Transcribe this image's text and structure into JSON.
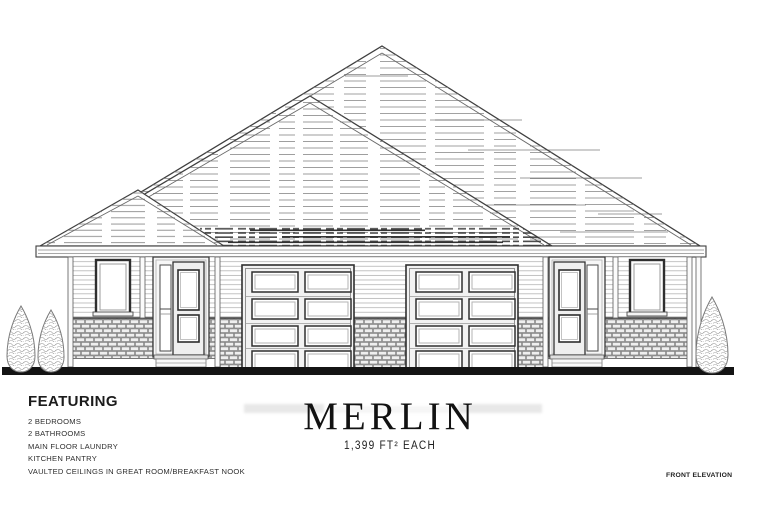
{
  "doc": {
    "featuring_heading": "FEATURING",
    "features": [
      "2 BEDROOMS",
      "2 BATHROOMS",
      "MAIN FLOOR LAUNDRY",
      "KITCHEN PANTRY",
      "VAULTED CEILINGS IN GREAT ROOM/BREAKFAST NOOK"
    ],
    "model_name": "MERLIN",
    "area_label": "1,399 FT² EACH",
    "view_label": "FRONT ELEVATION"
  },
  "scene": {
    "description_elements": {
      "roof": "hip-roof-with-shingle-hatching",
      "garage_doors": 2,
      "entry_doors": 2,
      "windows": 2,
      "trees_left": 2,
      "trees_right": 1
    }
  },
  "colors": {
    "paper": "#ffffff",
    "line": "#3c3c3c",
    "ground": "#141414",
    "brick_fill": "#dcdcdc",
    "garage_face": "#f2f2f2"
  }
}
